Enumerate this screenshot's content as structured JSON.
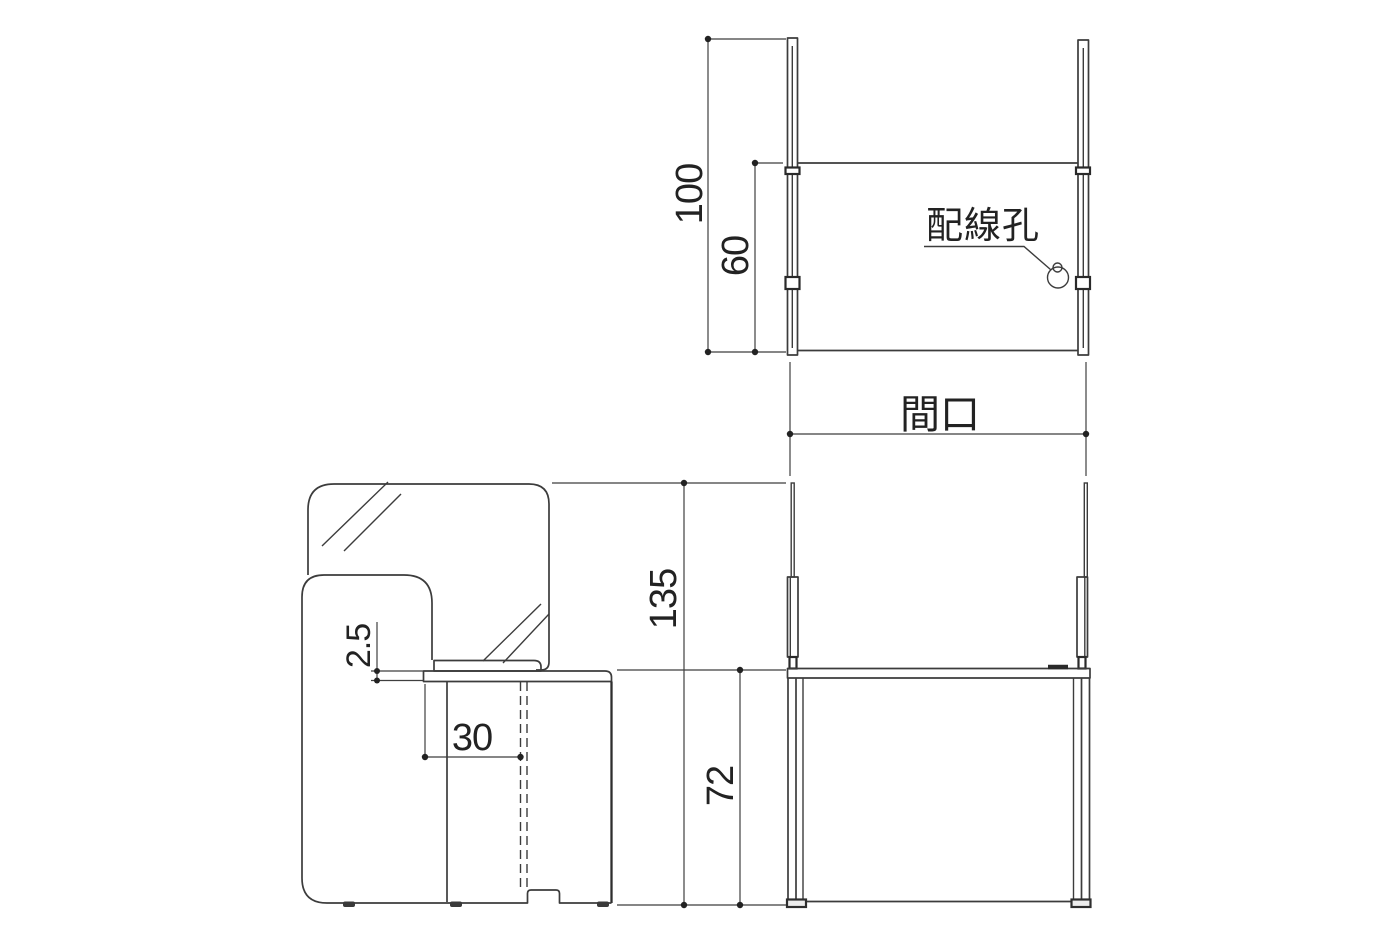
{
  "drawing": {
    "background_color": "#ffffff",
    "line_color": "#3c3c3c",
    "text_color": "#222222",
    "top_view": {
      "panel_length_dim": "100",
      "desk_depth_dim": "60",
      "wiring_hole_label": "配線孔"
    },
    "frontage_label": "間口",
    "side_view": {
      "desktop_thickness_dim": "2.5",
      "wiring_offset_dim": "30"
    },
    "front_view": {
      "overall_height_dim": "135",
      "desktop_height_dim": "72"
    }
  }
}
